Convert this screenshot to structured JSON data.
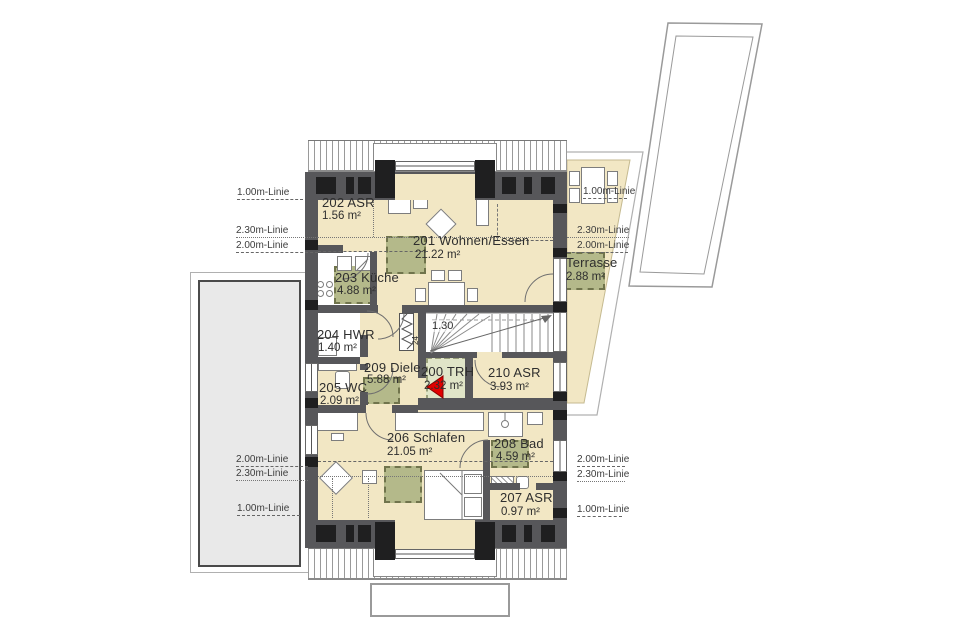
{
  "rooms": [
    {
      "name": "202 ASR",
      "area": "1.56 m²"
    },
    {
      "name": "201 Wohnen/Essen",
      "area": "21.22 m²"
    },
    {
      "name": "203 Küche",
      "area": "4.88 m²"
    },
    {
      "name": "204 HWR",
      "area": "1.40 m²"
    },
    {
      "name": "205 WC",
      "area": "2.09 m²"
    },
    {
      "name": "209 Diele",
      "area": "5.88 m²"
    },
    {
      "name": "200 TRH",
      "area": "2.32 m²"
    },
    {
      "name": "210 ASR",
      "area": "3.93 m²"
    },
    {
      "name": "206 Schlafen",
      "area": "21.05 m²"
    },
    {
      "name": "208 Bad",
      "area": "4.59 m²"
    },
    {
      "name": "207 ASR",
      "area": "0.97 m²"
    },
    {
      "name": "Terrasse",
      "area": "2.88 m²"
    }
  ],
  "height_lines": {
    "left_top": [
      "1.00m-Linie",
      "2.30m-Linie",
      "2.00m-Linie"
    ],
    "left_bottom": [
      "2.00m-Linie",
      "2.30m-Linie",
      "1.00m-Linie"
    ],
    "right_top": [
      "1.00m-Linie",
      "2.30m-Linie",
      "2.00m-Linie"
    ],
    "right_bottom": [
      "2.00m-Linie",
      "2.30m-Linie",
      "1.00m-Linie"
    ]
  },
  "stair": {
    "run_width": "1.30",
    "tread_depth": "24"
  },
  "colors": {
    "room_fill": "#f2e7c4",
    "roof_window_marker": "#b4b98a",
    "stair_marker": "#e0e5c8",
    "wall": "#57575a",
    "wall_dark": "#1f1f20",
    "neighbor_fill": "#e9e9e9",
    "entry_arrow": "#e10000"
  }
}
